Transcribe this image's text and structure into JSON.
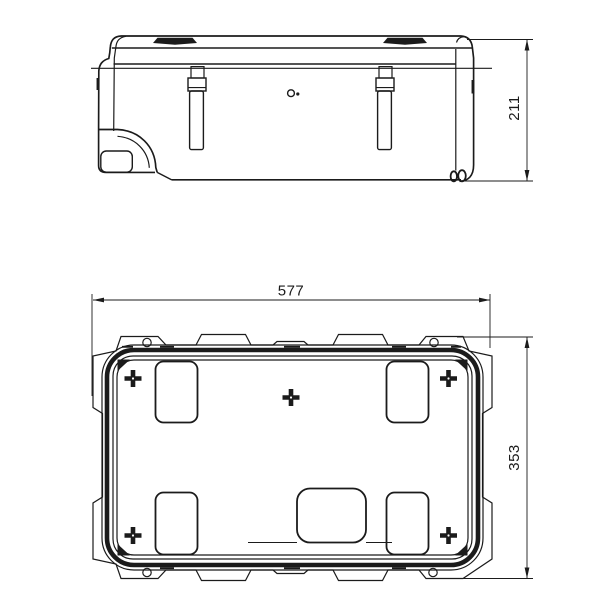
{
  "drawing": {
    "kind": "technical-drawing-two-views",
    "line_color": "#1b1b1b",
    "background_color": "#ffffff",
    "dimensions": {
      "width": "577",
      "height": "353",
      "depth": "211"
    }
  }
}
